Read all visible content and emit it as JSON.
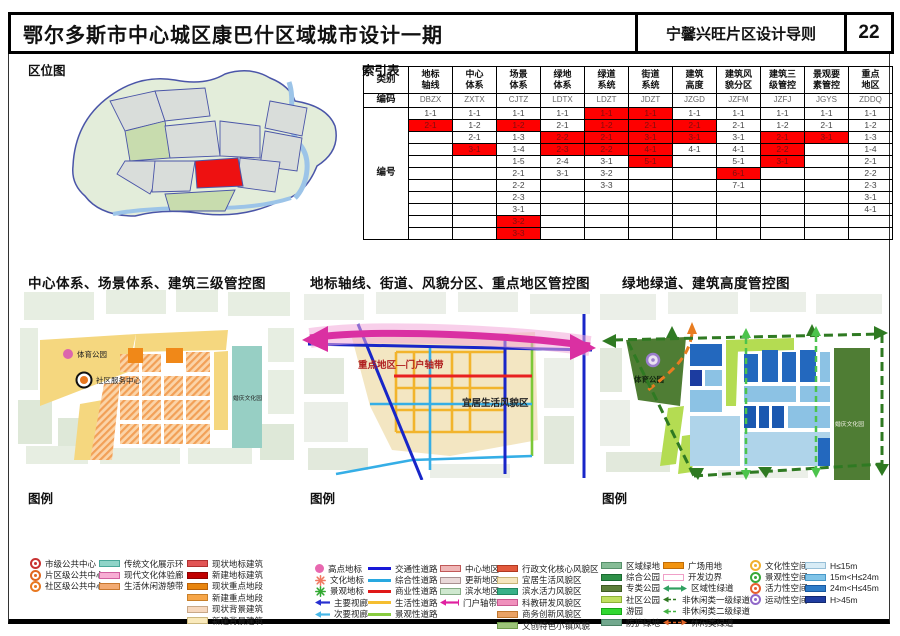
{
  "header": {
    "title": "鄂尔多斯市中心城区康巴什区域城市设计一期",
    "subtitle": "宁馨兴旺片区设计导则",
    "page": "22"
  },
  "sections": {
    "location_label": "区位图",
    "index_label": "索引表",
    "legend_label": "图例"
  },
  "index_table": {
    "row_headers": {
      "category": "类别",
      "code": "编码",
      "number": "编号"
    },
    "columns": [
      {
        "name_lines": [
          "地标",
          "轴线"
        ],
        "code": "DBZX"
      },
      {
        "name_lines": [
          "中心",
          "体系"
        ],
        "code": "ZXTX"
      },
      {
        "name_lines": [
          "场景",
          "体系"
        ],
        "code": "CJTZ"
      },
      {
        "name_lines": [
          "绿地",
          "体系"
        ],
        "code": "LDTX"
      },
      {
        "name_lines": [
          "绿道",
          "系统"
        ],
        "code": "LDZT"
      },
      {
        "name_lines": [
          "街道",
          "系统"
        ],
        "code": "JDZT"
      },
      {
        "name_lines": [
          "建筑",
          "高度"
        ],
        "code": "JZGD"
      },
      {
        "name_lines": [
          "建筑风",
          "貌分区"
        ],
        "code": "JZFM"
      },
      {
        "name_lines": [
          "建筑三",
          "级管控"
        ],
        "code": "JZFJ"
      },
      {
        "name_lines": [
          "景观要",
          "素管控"
        ],
        "code": "JGYS"
      },
      {
        "name_lines": [
          "重点",
          "地区"
        ],
        "code": "ZDDQ"
      }
    ],
    "rows": [
      [
        "1-1",
        "1-1",
        "1-1",
        "1-1",
        "1-1!",
        "1-1!",
        "1-1",
        "1-1",
        "1-1",
        "1-1",
        "1-1"
      ],
      [
        "2-1!",
        "1-2",
        "1-2!",
        "2-1",
        "1-2!",
        "2-1!",
        "2-1!",
        "2-1",
        "1-2",
        "2-1",
        "1-2"
      ],
      [
        "",
        "2-1",
        "1-3",
        "2-2!",
        "2-1!",
        "3-1!",
        "3-1!",
        "3-1",
        "2-1!",
        "3-1!",
        "1-3"
      ],
      [
        "",
        "3-1!",
        "1-4",
        "2-3!",
        "2-2!",
        "4-1!",
        "4-1",
        "4-1",
        "2-2!",
        "",
        "1-4"
      ],
      [
        "",
        "",
        "1-5",
        "2-4",
        "3-1",
        "5-1!",
        "",
        "5-1",
        "3-1!",
        "",
        "2-1"
      ],
      [
        "",
        "",
        "2-1",
        "3-1",
        "3-2",
        "",
        "",
        "6-1!",
        "",
        "",
        "2-2"
      ],
      [
        "",
        "",
        "2-2",
        "",
        "3-3",
        "",
        "",
        "7-1",
        "",
        "",
        "2-3"
      ],
      [
        "",
        "",
        "2-3",
        "",
        "",
        "",
        "",
        "",
        "",
        "",
        "3-1"
      ],
      [
        "",
        "",
        "3-1",
        "",
        "",
        "",
        "",
        "",
        "",
        "",
        "4-1"
      ],
      [
        "",
        "",
        "3-2!",
        "",
        "",
        "",
        "",
        "",
        "",
        "",
        ""
      ],
      [
        "",
        "",
        "3-3!",
        "",
        "",
        "",
        "",
        "",
        "",
        "",
        ""
      ]
    ]
  },
  "maps": [
    {
      "title": "中心体系、场景体系、建筑三级管控图",
      "labels": {
        "sports_park": "体育公园",
        "community_center": "社区服务中心",
        "wedding_park": "婚庆文化园"
      }
    },
    {
      "title": "地标轴线、街道、风貌分区、重点地区管控图",
      "labels": {
        "axis": "重点地区—门户轴带",
        "livable": "宜居生活风貌区"
      }
    },
    {
      "title": "绿地绿道、建筑高度管控图",
      "labels": {
        "sports_park": "体育公园",
        "wedding_park": "婚庆文化园"
      }
    }
  ],
  "legends": [
    {
      "cols": [
        [
          {
            "label": "市级公共中心",
            "icon": "ring",
            "color": "#C83232"
          },
          {
            "label": "片区级公共中心",
            "icon": "ring",
            "color": "#E06820"
          },
          {
            "label": "社区级公共中心",
            "icon": "ring",
            "color": "#E87820"
          }
        ],
        [
          {
            "label": "传统文化展示环",
            "icon": "swatch",
            "color": "#8FD4C8",
            "border": "#4AA89A"
          },
          {
            "label": "现代文化体验廊",
            "icon": "swatch",
            "color": "#F7AED4",
            "border": "#D060A0"
          },
          {
            "label": "生活休闲游憩带",
            "icon": "swatch",
            "color": "#F2AA72",
            "border": "#C87830"
          }
        ],
        [
          {
            "label": "现状地标建筑",
            "icon": "swatch",
            "color": "#E25555",
            "border": "#B03030"
          },
          {
            "label": "新建地标建筑",
            "icon": "swatch",
            "color": "#C00000",
            "border": "#8E0000"
          },
          {
            "label": "现状重点地段",
            "icon": "swatch",
            "color": "#E8850F",
            "border": "#B86008"
          },
          {
            "label": "新建重点地段",
            "icon": "swatch",
            "color": "#F7A648",
            "border": "#C8802A"
          },
          {
            "label": "现状背景建筑",
            "icon": "swatch",
            "color": "#F6D8BE",
            "border": "#C8A888"
          },
          {
            "label": "新建背景建筑",
            "icon": "swatch",
            "color": "#F9E9BB",
            "border": "#CCB87E"
          }
        ]
      ]
    },
    {
      "cols": [
        [
          {
            "label": "高点地标",
            "icon": "dot",
            "color": "#E868B0"
          },
          {
            "label": "文化地标",
            "icon": "star",
            "color": "#F07860"
          },
          {
            "label": "景观地标",
            "icon": "star",
            "color": "#30A830"
          },
          {
            "label": "主要视廊",
            "icon": "arrow",
            "color": "#2830D0"
          },
          {
            "label": "次要视廊",
            "icon": "arrow",
            "color": "#48B8E8"
          }
        ],
        [
          {
            "label": "交通性道路",
            "icon": "line",
            "color": "#1818D8"
          },
          {
            "label": "综合性道路",
            "icon": "line",
            "color": "#28A8E0"
          },
          {
            "label": "商业性道路",
            "icon": "line",
            "color": "#E01818"
          },
          {
            "label": "生活性道路",
            "icon": "line",
            "color": "#F5BE30"
          },
          {
            "label": "景观性道路",
            "icon": "line",
            "color": "#88CC40"
          }
        ],
        [
          {
            "label": "中心地区",
            "icon": "swatch",
            "color": "#EFB6B6",
            "border": "#C05858"
          },
          {
            "label": "更新地区",
            "icon": "swatch",
            "color": "#E9D9D9",
            "border": "#A89090"
          },
          {
            "label": "滨水地区",
            "icon": "swatch",
            "color": "#CFE8CF",
            "border": "#86AC86"
          },
          {
            "label": "门户轴带",
            "icon": "arrow",
            "color": "#E020A0"
          }
        ],
        [
          {
            "label": "行政文化核心风貌区",
            "icon": "swatch",
            "color": "#E2593C",
            "border": "#B03820"
          },
          {
            "label": "宜居生活风貌区",
            "icon": "swatch",
            "color": "#F5E6BE",
            "border": "#C8B478"
          },
          {
            "label": "滨水活力风貌区",
            "icon": "swatch",
            "color": "#38B088",
            "border": "#1F8860"
          },
          {
            "label": "科教研发风貌区",
            "icon": "swatch",
            "color": "#F090BC",
            "border": "#C85890"
          },
          {
            "label": "商务创新风貌区",
            "icon": "swatch",
            "color": "#EAA264",
            "border": "#C07830"
          },
          {
            "label": "文创特色小镇风貌",
            "icon": "swatch",
            "color": "#9CC478",
            "border": "#6E9A4A"
          }
        ]
      ]
    },
    {
      "cols": [
        [
          {
            "label": "区域绿地",
            "icon": "swatch",
            "color": "#86BC96",
            "border": "#56906A"
          },
          {
            "label": "综合公园",
            "icon": "swatch",
            "color": "#2E9048",
            "border": "#1A6A30"
          },
          {
            "label": "专类公园",
            "icon": "swatch",
            "color": "#5C7E3A",
            "border": "#3E5A24"
          },
          {
            "label": "社区公园",
            "icon": "swatch",
            "color": "#C0E060",
            "border": "#8CB038"
          },
          {
            "label": "游园",
            "icon": "swatch",
            "color": "#30D830",
            "border": "#18A818"
          },
          {
            "label": "防护绿地",
            "icon": "swatch",
            "color": "#72A88E",
            "border": "#4A8064"
          }
        ],
        [
          {
            "label": "广场用地",
            "icon": "swatch",
            "color": "#F2930F",
            "border": "#C06C08"
          },
          {
            "label": "开发边界",
            "icon": "swatch",
            "color": "#FFFFFF",
            "border": "#F0A0C8"
          },
          {
            "label": "区域性绿道",
            "icon": "arrow",
            "color": "#30A060"
          },
          {
            "label": "非休闲类一级绿道",
            "icon": "dasharrow",
            "color": "#2E7820"
          },
          {
            "label": "非休闲类二级绿道",
            "icon": "dasharrow",
            "color": "#44B244"
          },
          {
            "label": "休闲类绿道",
            "icon": "dasharrow",
            "color": "#E06428"
          }
        ],
        [
          {
            "label": "文化性空间",
            "icon": "ring2",
            "color": "#F0B030"
          },
          {
            "label": "景观性空间",
            "icon": "ring2",
            "color": "#38A838"
          },
          {
            "label": "活力性空间",
            "icon": "ring2",
            "color": "#E86030"
          },
          {
            "label": "运动性空间",
            "icon": "ring2",
            "color": "#9068C8"
          }
        ],
        [
          {
            "label": "H≤15m",
            "icon": "swatch",
            "color": "#D8ECF6",
            "border": "#98C0D8"
          },
          {
            "label": "15m<H≤24m",
            "icon": "swatch",
            "color": "#80C4E8",
            "border": "#4898C8"
          },
          {
            "label": "24m<H≤45m",
            "icon": "swatch",
            "color": "#2E7CC8",
            "border": "#1858A0"
          },
          {
            "label": "H>45m",
            "icon": "swatch",
            "color": "#1F3CA0",
            "border": "#122870"
          }
        ]
      ]
    }
  ]
}
